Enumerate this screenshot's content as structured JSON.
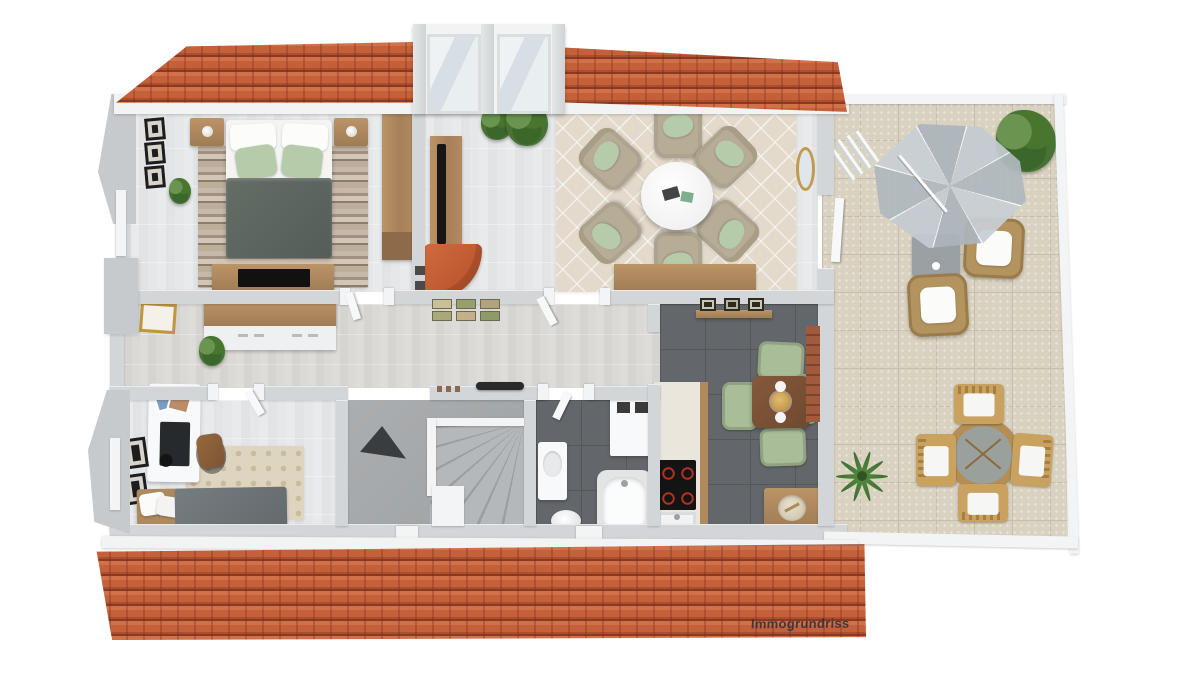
{
  "watermark": {
    "label": "Immogrundriss"
  },
  "palette": {
    "roof": "#c9683f",
    "roof_line": "#7e3420",
    "eave": "#f2f4f4",
    "wall": "#d3d6d8",
    "wall_trim": "#f2f4f5",
    "floor_wood_light": "#e5e6e8",
    "floor_wood_hall": "#dbd9d6",
    "floor_tile_dark": "#63666a",
    "tile_grout_dark": "#55585a",
    "terrace_tile": "#d9d2c1",
    "terrace_grout": "#c6bfae",
    "rug_living": "#e3dacc",
    "rug_office": "#ded5c0",
    "duvet": "#5c655f",
    "pillow_green": "#b6cba9",
    "armchair": "#b7ad97",
    "sofa_orange": "#c75f36",
    "wood": "#b08a5c",
    "stairs": "#a6a9ab",
    "kitchen_chair": "#a9bd98",
    "kitchen_table": "#7a5136",
    "plant": "#477434",
    "parasol": "#bcc5cb",
    "wicker": "#b3945f",
    "brick": "#9a5a40"
  },
  "scene": {
    "type": "3d-floor-plan-top-view",
    "description": "Rendered upper-floor plan with orange tiled roof strips, dormer with two windows, and side terrace",
    "rooms": [
      {
        "id": "bedroom",
        "position": "top-left",
        "contents": [
          "double bed with 2 green pillows",
          "2 nightstands with lamps",
          "striped rug",
          "dresser with flat TV",
          "tall wardrobe",
          "3 wall frames",
          "plant"
        ]
      },
      {
        "id": "living-room",
        "position": "top-center",
        "contents": [
          "6 beige armchairs with green pillows",
          "round white coffee table",
          "diamond-pattern rug",
          "wooden sideboard",
          "TV lowboard with TV",
          "orange lounge chair",
          "2 green shrubs",
          "gold oval mirror",
          "terrace door"
        ]
      },
      {
        "id": "hallway",
        "position": "middle",
        "contents": [
          "6 small pictures",
          "coat rail",
          "shoes"
        ]
      },
      {
        "id": "office-guest-room",
        "position": "bottom-left",
        "contents": [
          "white desk with monitor",
          "desk chair",
          "single bed",
          "dotted rug",
          "wardrobe",
          "gold-framed picture",
          "2 wall frames",
          "plant"
        ]
      },
      {
        "id": "staircase",
        "position": "bottom-center",
        "contents": [
          "winder stairs",
          "dark void arrow"
        ]
      },
      {
        "id": "bathroom",
        "position": "bottom-center-right",
        "contents": [
          "bathtub",
          "vanity basin",
          "toilet",
          "white cabinet with 2 vents"
        ]
      },
      {
        "id": "kitchen",
        "position": "bottom-right",
        "contents": [
          "counter with cooktop and sink",
          "dining table with 4 green chairs",
          "sideboard with bowl",
          "picture sideboard",
          "brick accent wall"
        ]
      },
      {
        "id": "terrace",
        "position": "right",
        "contents": [
          "octagonal parasol",
          "2 wicker armchairs with white cushions",
          "gray side table",
          "folded lounger",
          "round dining table with 4 wooden chairs",
          "corner plant",
          "palm plant",
          "glass railing"
        ]
      }
    ]
  }
}
